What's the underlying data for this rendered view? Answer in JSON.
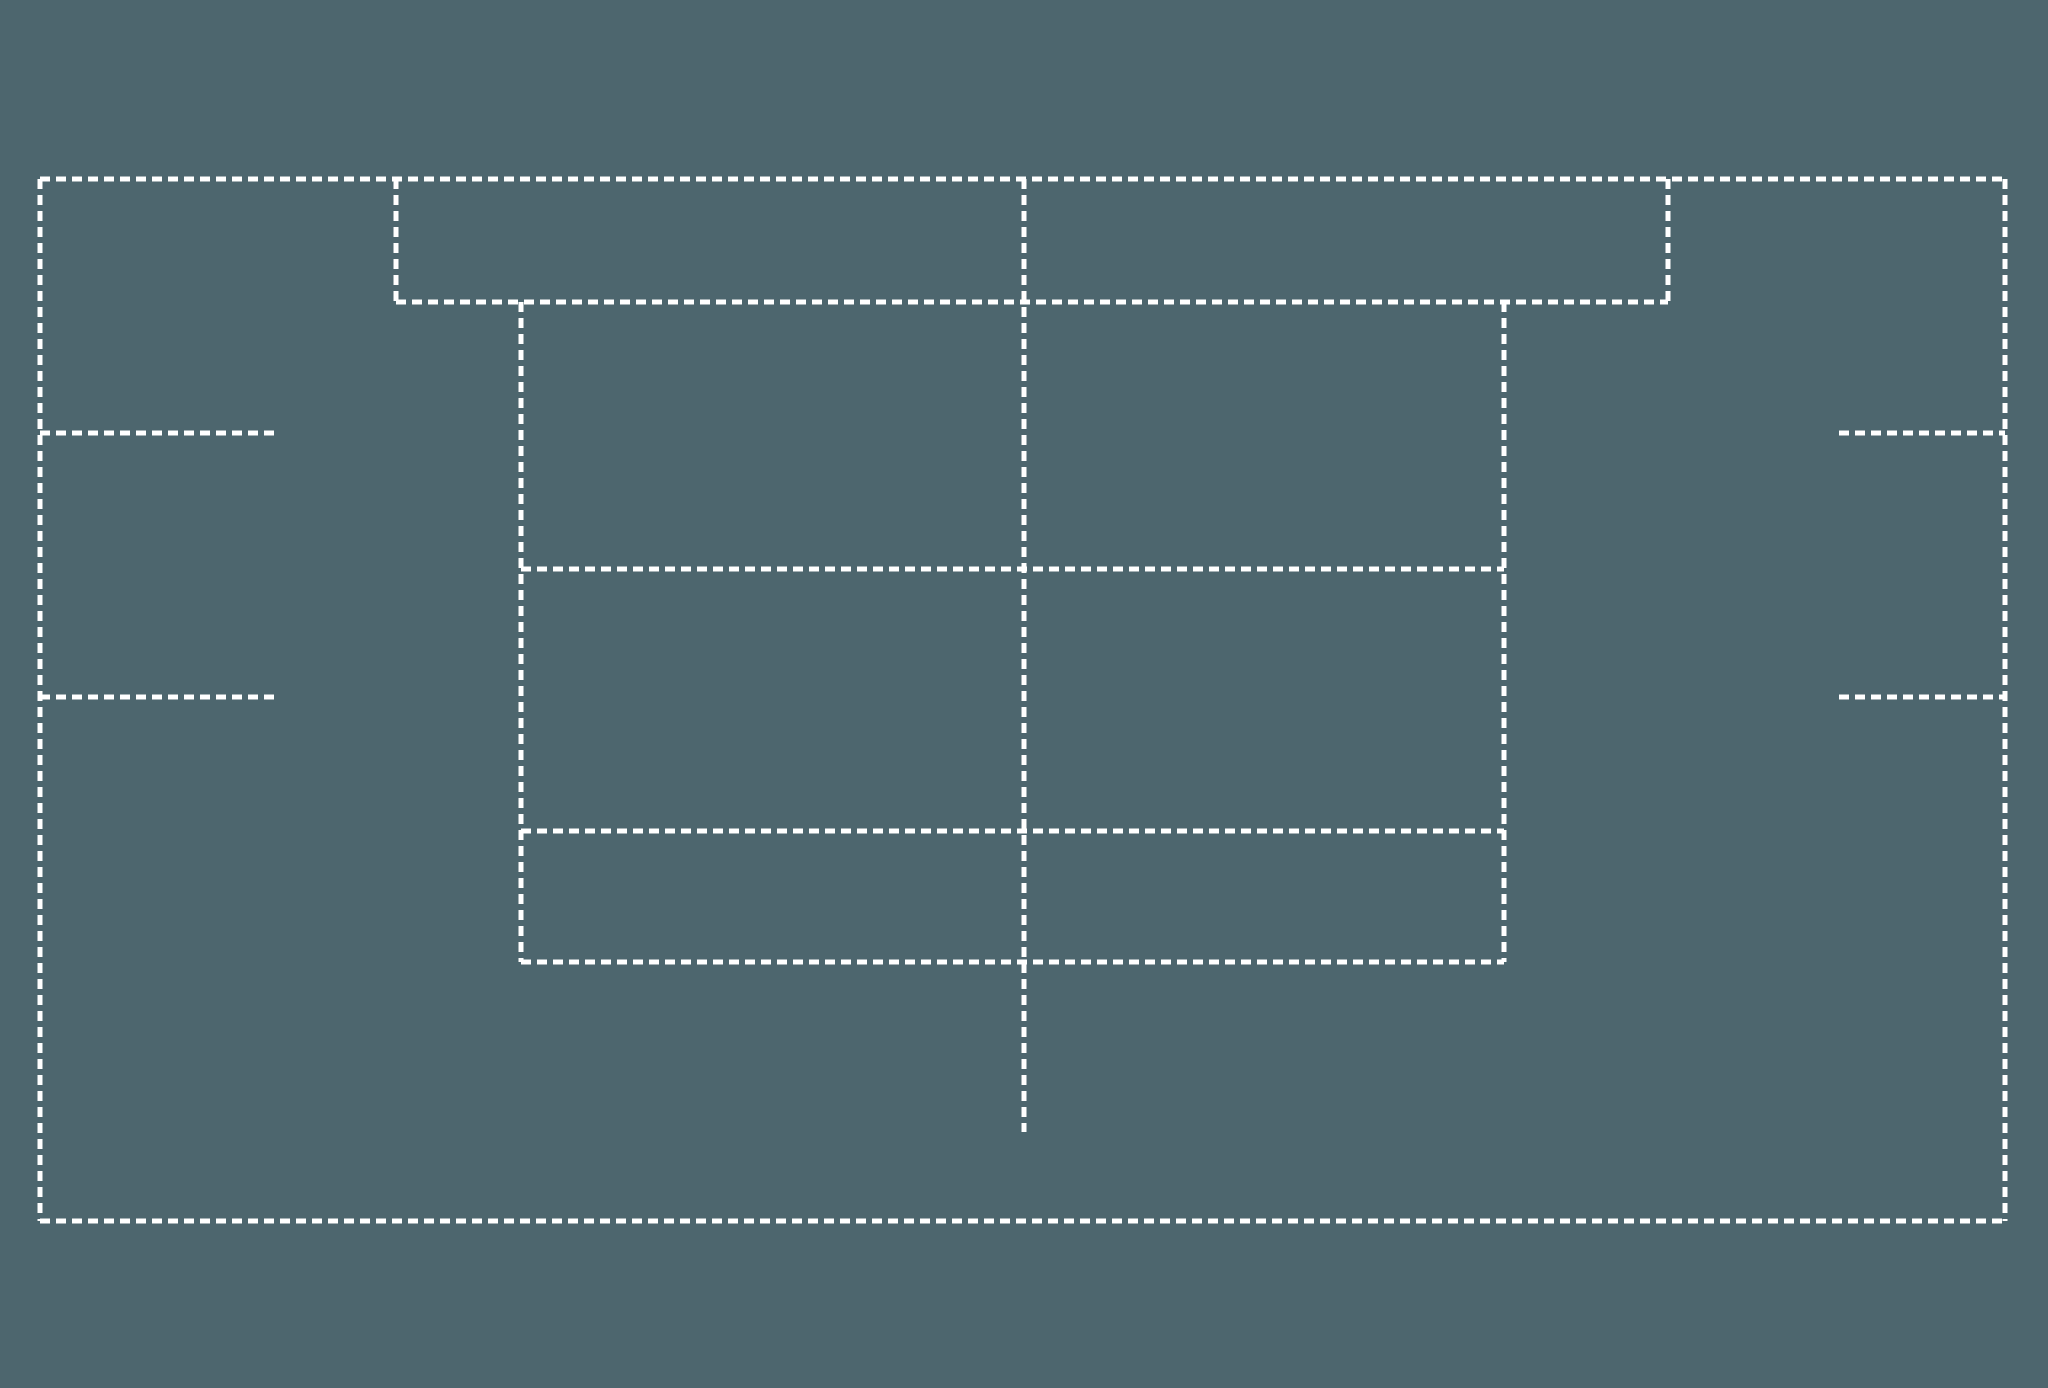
{
  "diagram": {
    "background_color": "#4d666e",
    "line_color": "#ffffff",
    "line_width": 5,
    "dash_pattern": "10 6",
    "canvas": {
      "width": 2048,
      "height": 1388
    },
    "segments": [
      {
        "name": "outer-top-edge",
        "x1": 40,
        "y1": 179,
        "x2": 2005,
        "y2": 179
      },
      {
        "name": "outer-left-edge",
        "x1": 40,
        "y1": 179,
        "x2": 40,
        "y2": 1221
      },
      {
        "name": "outer-bottom-edge",
        "x1": 40,
        "y1": 1221,
        "x2": 2005,
        "y2": 1221
      },
      {
        "name": "outer-right-edge",
        "x1": 2005,
        "y1": 179,
        "x2": 2005,
        "y2": 1221
      },
      {
        "name": "top-band-left-edge",
        "x1": 396,
        "y1": 179,
        "x2": 396,
        "y2": 302
      },
      {
        "name": "top-band-right-edge",
        "x1": 1668,
        "y1": 179,
        "x2": 1668,
        "y2": 302
      },
      {
        "name": "top-band-bottom-edge",
        "x1": 396,
        "y1": 302,
        "x2": 1668,
        "y2": 302
      },
      {
        "name": "inner-block-left-edge",
        "x1": 521,
        "y1": 302,
        "x2": 521,
        "y2": 962
      },
      {
        "name": "inner-block-right-edge",
        "x1": 1504,
        "y1": 302,
        "x2": 1504,
        "y2": 962
      },
      {
        "name": "inner-block-divider-1",
        "x1": 521,
        "y1": 569,
        "x2": 1504,
        "y2": 569
      },
      {
        "name": "inner-block-divider-2",
        "x1": 521,
        "y1": 831,
        "x2": 1504,
        "y2": 831
      },
      {
        "name": "inner-block-bottom-edge",
        "x1": 521,
        "y1": 962,
        "x2": 1504,
        "y2": 962
      },
      {
        "name": "center-vertical-line",
        "x1": 1024,
        "y1": 179,
        "x2": 1024,
        "y2": 1132
      },
      {
        "name": "left-tick-upper",
        "x1": 40,
        "y1": 433,
        "x2": 278,
        "y2": 433
      },
      {
        "name": "left-tick-lower",
        "x1": 40,
        "y1": 697,
        "x2": 278,
        "y2": 697
      },
      {
        "name": "right-tick-upper",
        "x1": 1839,
        "y1": 433,
        "x2": 2005,
        "y2": 433
      },
      {
        "name": "right-tick-lower",
        "x1": 1839,
        "y1": 697,
        "x2": 2005,
        "y2": 697
      }
    ]
  }
}
